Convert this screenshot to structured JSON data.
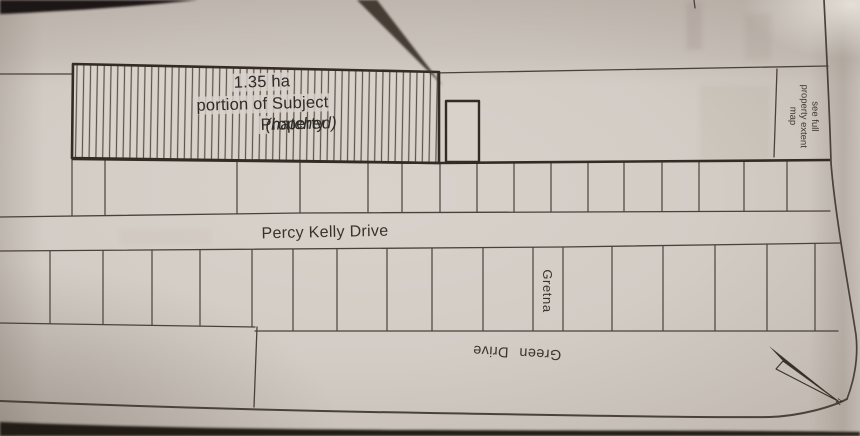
{
  "map": {
    "subject_property": {
      "area_label": "1.35 ha",
      "line2": "portion of Subject",
      "line3_regular": "Property",
      "line3_italic": "(hatched)"
    },
    "streets": {
      "percy_kelly": "Percy Kelly Drive",
      "gretna": "Gretna",
      "green_drive": "Green Drive"
    },
    "side_note": {
      "line1": "see full",
      "line2": "property extent",
      "line3": "map"
    },
    "north_arrow_label": "N"
  },
  "colors": {
    "paper": "#d5cec7",
    "ink": "#332d27",
    "thin_line": "#4a423a",
    "thick_line": "#332b24",
    "hatch": "#5c554d"
  }
}
